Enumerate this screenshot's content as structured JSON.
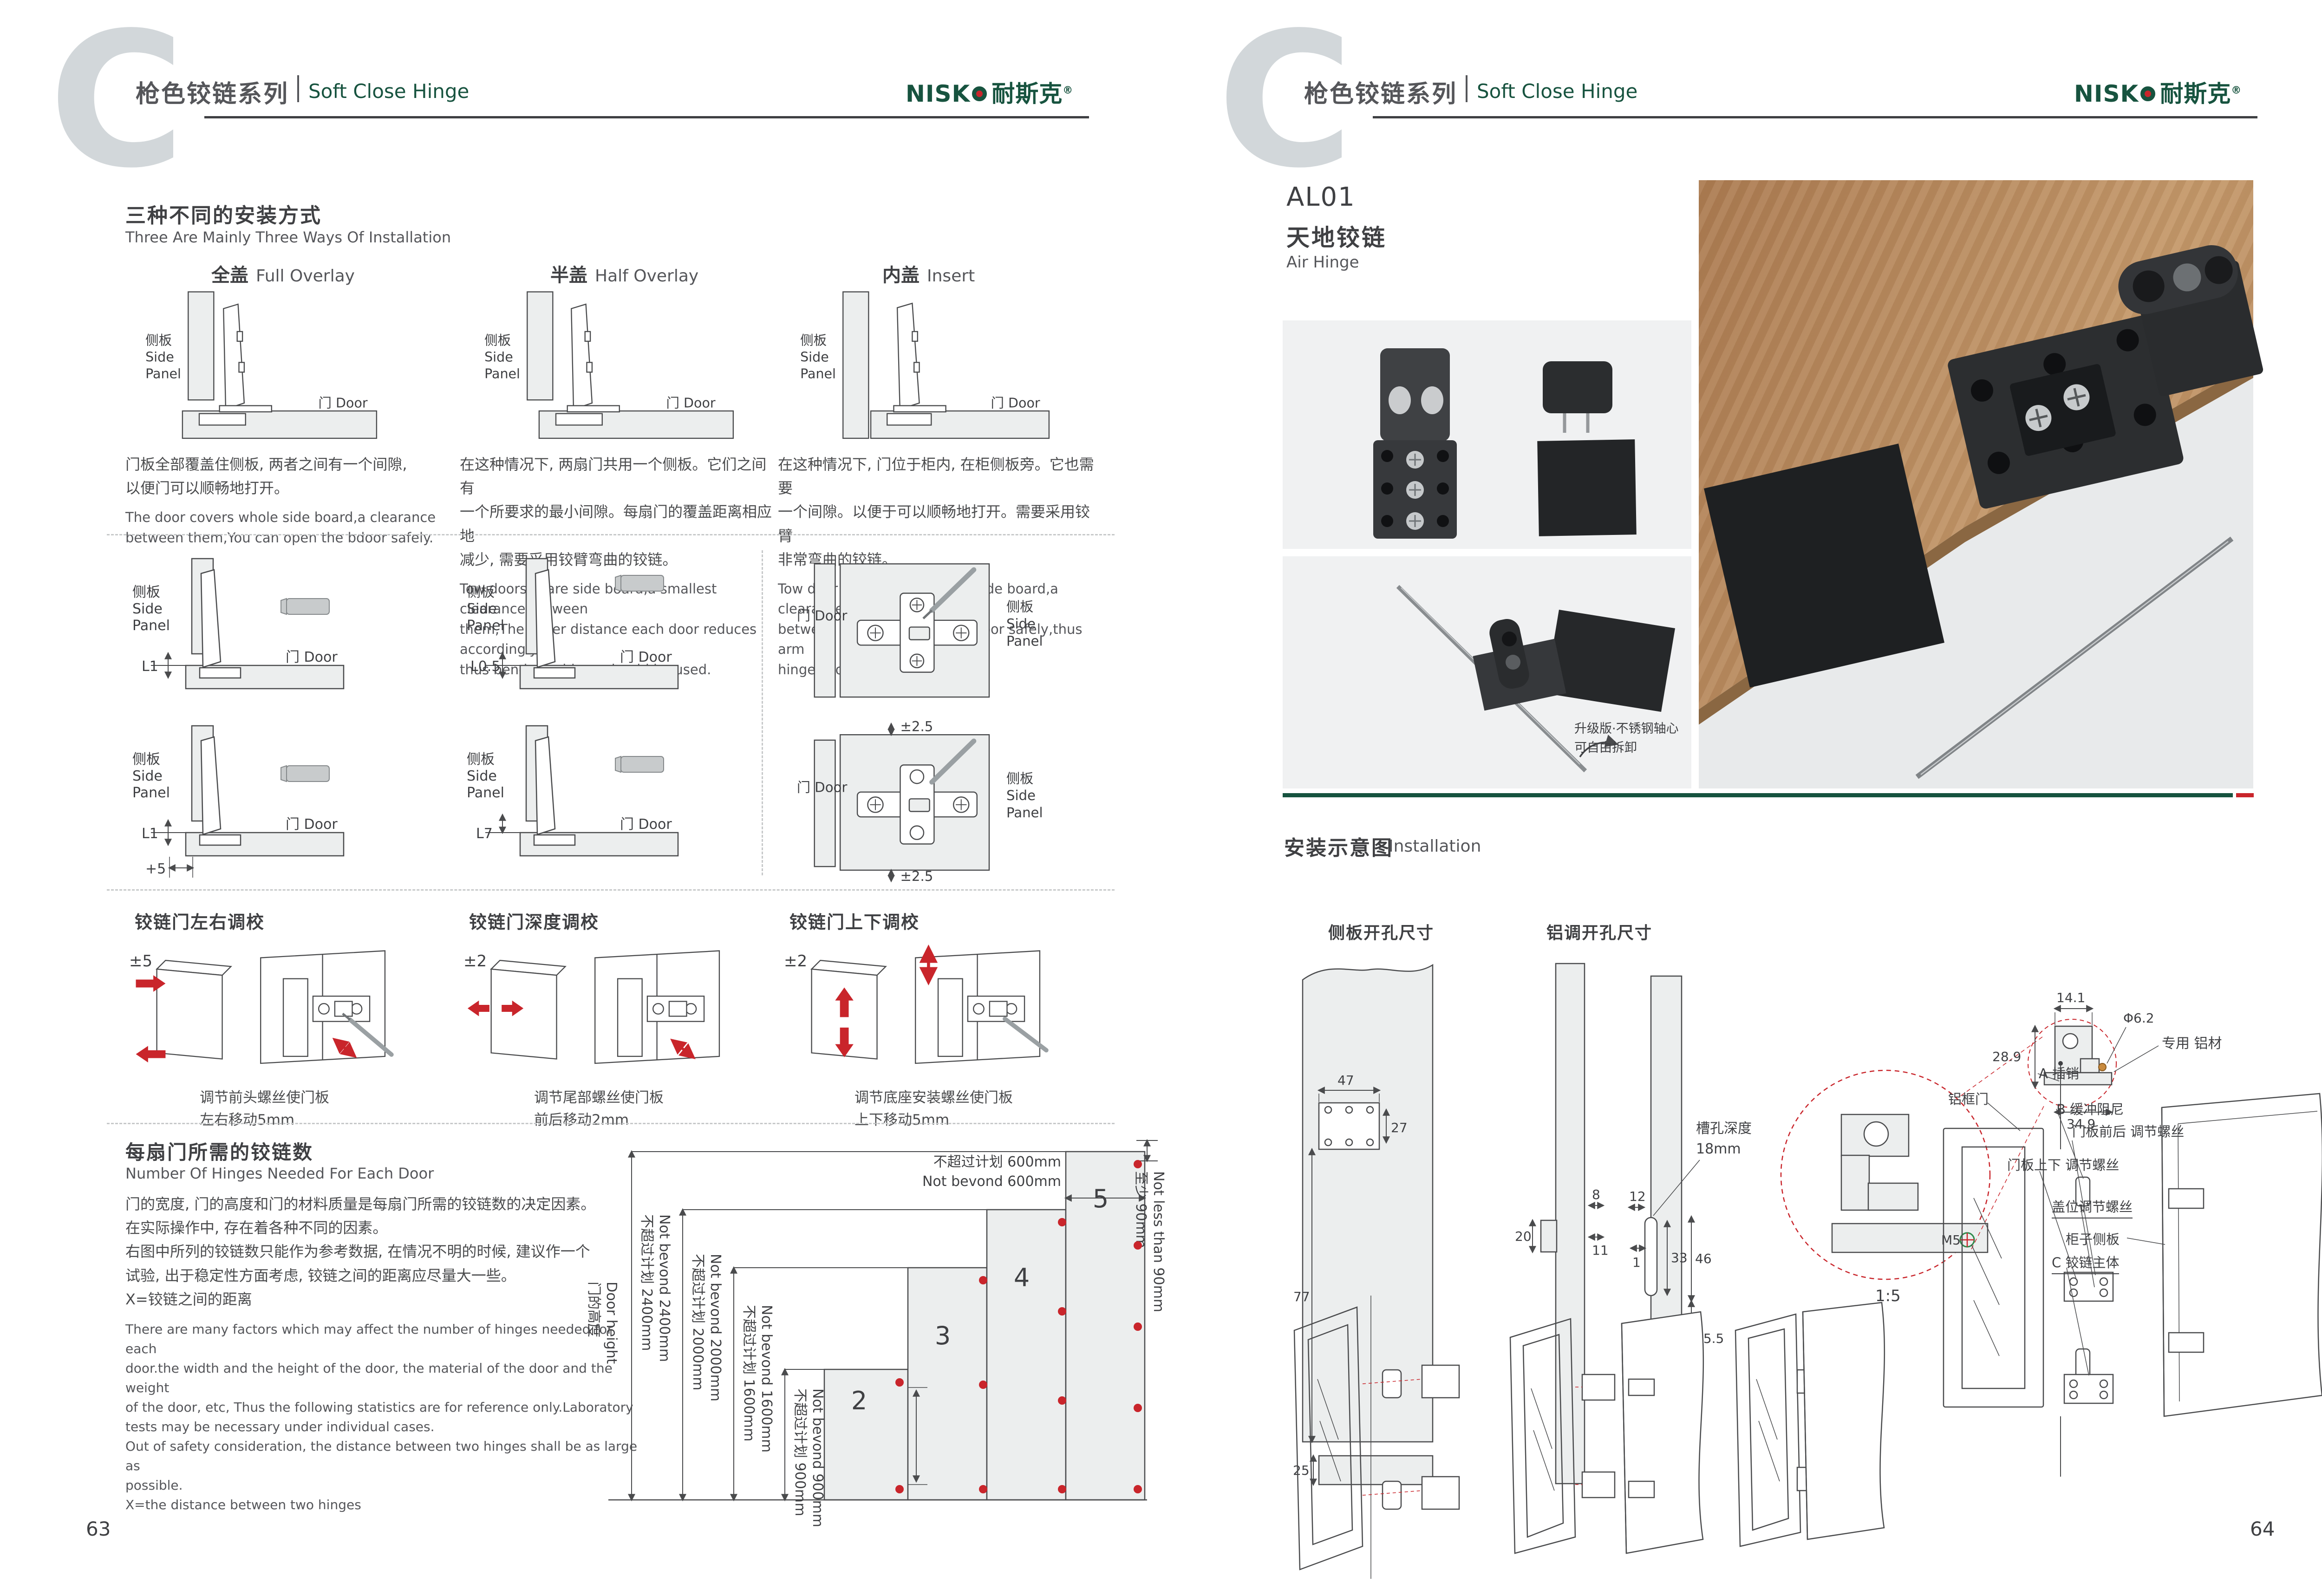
{
  "header": {
    "letter": "C",
    "series_cn": "枪色铰链系列",
    "series_en": "Soft Close Hinge",
    "brand_en": "NISK",
    "brand_cn": "耐斯克",
    "brand_reg": "®"
  },
  "left": {
    "page_no": "63",
    "methods": {
      "title_cn": "三种不同的安装方式",
      "title_en": "Three Are Mainly Three Ways Of Installation",
      "side_cn": "侧板",
      "side_en1": "Side",
      "side_en2": "Panel",
      "door_label": "门 Door",
      "items": [
        {
          "name_cn": "全盖",
          "name_en": "Full Overlay",
          "desc_cn": "门板全部覆盖住侧板, 两者之间有一个间隙,\n以便门可以顺畅地打开。",
          "desc_en": "The door covers whole side board,a clearance\nbetween them,You can open the bdoor safely."
        },
        {
          "name_cn": "半盖",
          "name_en": "Half Overlay",
          "desc_cn": "在这种情况下, 两扇门共用一个侧板。它们之间有\n一个所要求的最小间隙。每扇门的覆盖距离相应地\n减少, 需要采用铰臂弯曲的铰链。",
          "desc_en": "Tow doors share side board,a smallest clearance between\nthem,The cover distance each door reduces accordingly,\nthus bend arm hinge should be used."
        },
        {
          "name_cn": "内盖",
          "name_en": "Insert",
          "desc_cn": "在这种情况下, 门位于柜内, 在柜侧板旁。它也需要\n一个间隙。以便于可以顺畅地打开。需要采用铰臂\n非常弯曲的铰链。",
          "desc_en": "Tow door lies in cabinet,near side board,a clearance\nbetween them.You can open door safely,thus arm\nhinge should be used."
        }
      ]
    },
    "clearance": {
      "labels": [
        "L1",
        "L0.5",
        "L1",
        "L7"
      ],
      "offset": "+5",
      "plate_tol": "±2.5"
    },
    "adjust": [
      {
        "title": "铰链门左右调校",
        "tol": "±5",
        "cap": "调节前头螺丝使门板\n左右移动5mm"
      },
      {
        "title": "铰链门深度调校",
        "tol": "±2",
        "cap": "调节尾部螺丝使门板\n前后移动2mm"
      },
      {
        "title": "铰链门上下调校",
        "tol": "±2",
        "cap": "调节底座安装螺丝使门板\n上下移动5mm"
      }
    ],
    "hinges_needed": {
      "title_cn": "每扇门所需的铰链数",
      "title_en": "Number Of Hinges Needed For Each Door",
      "desc_cn": "门的宽度, 门的高度和门的材料质量是每扇门所需的铰链数的决定因素。\n在实际操作中, 存在着各种不同的因素。\n右图中所列的铰链数只能作为参考数据, 在情况不明的时候, 建议作一个\n试验, 出于稳定性方面考虑, 铰链之间的距离应尽量大一些。\nX=铰链之间的距离",
      "desc_en": "There are many factors which may affect the number of hinges needed for each\ndoor.the width and the height of the door, the material of the door and the weight\nof the door, etc, Thus the following statistics are for reference only.Laboratory\ntests may be necessary under individual cases.\nOut of safety consideration, the distance between two hinges shall be as large as\npossible.\nX=the distance between two hinges",
      "chart": {
        "type": "bar",
        "axis_cn": "门的高度",
        "axis_en": "Door height",
        "bars": [
          {
            "n": "2",
            "mm": 900
          },
          {
            "n": "3",
            "mm": 1600
          },
          {
            "n": "4",
            "mm": 2000
          },
          {
            "n": "5",
            "mm": 2400
          }
        ],
        "lim2400_cn": "不超过计划 2400mm",
        "lim2400_en": "Not bevond 2400mm",
        "lim2000_cn": "不超过计划 2000mm",
        "lim2000_en": "Not bevond 2000mm",
        "lim1600_cn": "不超过计划 1600mm",
        "lim1600_en": "Not bevond 1600mm",
        "lim900_cn": "不超过计划 900mm",
        "lim900_en": "Not bevond 900mm",
        "lim600_cn": "不超过计划 600mm",
        "lim600_en": "Not bevond 600mm",
        "min90_cn": "至少 90mm",
        "min90_en": "Not less than 90mm"
      }
    }
  },
  "right": {
    "page_no": "64",
    "product": {
      "code": "AL01",
      "name_cn": "天地铰链",
      "name_en": "Air Hinge"
    },
    "photo_note": "升级版·不锈钢轴心\n可自由拆卸",
    "install": {
      "title_cn": "安装示意图",
      "title_en": "Installation",
      "side_drill": {
        "title": "侧板开孔尺寸",
        "d47": "47",
        "d27": "27",
        "d77": "77",
        "d25": "25"
      },
      "alu_drill": {
        "title": "铝调开孔尺寸",
        "note1": "槽孔深度",
        "note2": "18mm",
        "d8": "8",
        "d20": "20",
        "d11": "11",
        "d12": "12",
        "d1": "1",
        "d33": "33",
        "d46": "46",
        "d155": "15.5",
        "m5": "M5"
      },
      "detail": {
        "d141": "14.1",
        "d289": "28.9",
        "d349": "34.9",
        "dia": "Φ6.2",
        "alu": "专用\n铝材",
        "m5": "M5",
        "scale": "1:5"
      },
      "labels": {
        "frame": "铝框门",
        "pin": "A 插销",
        "damper": "B 缓冲阻尼",
        "fb": "门板前后\n调节螺丝",
        "ud": "门板上下\n调节螺丝",
        "cover": "盖位调节螺丝",
        "cab": "柜子侧板",
        "body": "C 铰链主体"
      }
    }
  }
}
